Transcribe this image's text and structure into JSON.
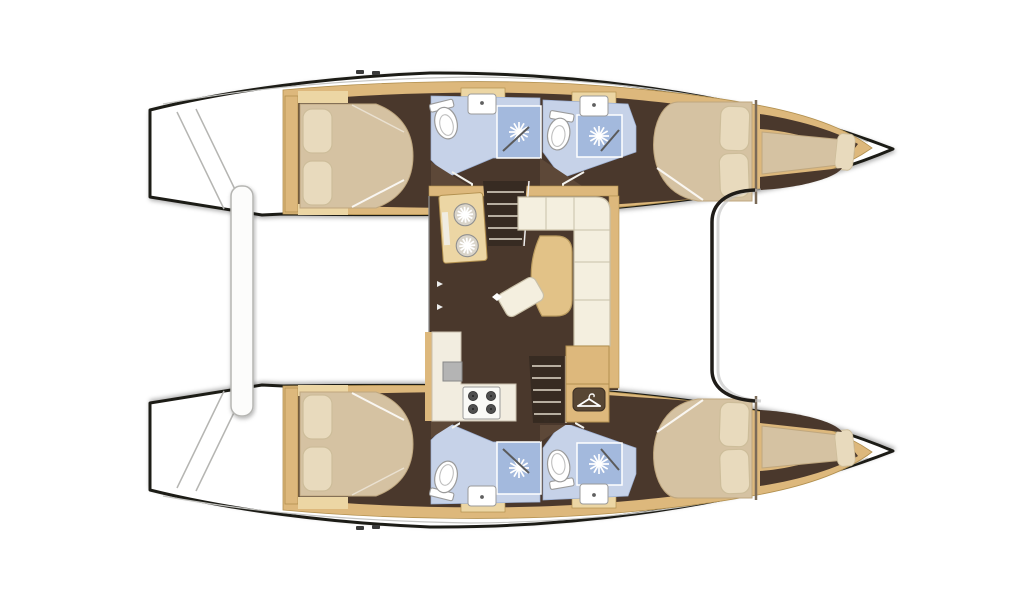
{
  "page": {
    "background": "#ffffff",
    "subject": "catamaran-interior-floor-plan",
    "view": "top-down"
  },
  "layout_info": {
    "vessel": "catamaran",
    "bow_side": "right",
    "stern_side": "left",
    "cabins": 4,
    "heads_with_shower": 4,
    "forepeak_berths": 2
  },
  "palette": {
    "outline": "#1f1c18",
    "deck": "#ffffff",
    "deck_line": "#c4c4c1",
    "wood_trim": "#ddb87c",
    "wood_light": "#ecd6a4",
    "wood_edge": "#b2904f",
    "floor_dark": "#4a382c",
    "floor_wedge": "#5d4838",
    "bed": "#d5c2a2",
    "bed_edge": "#bfa77f",
    "pillow": "#e8dabd",
    "pillow_edge": "#cdbd9a",
    "sofa": "#f4efdf",
    "sofa_edge": "#c9c0a8",
    "table": "#e2c287",
    "table_edge": "#bb9c60",
    "bath_floor": "#c6d2e8",
    "bath_floor_edge": "#9db0d2",
    "shower": "#a3b9dd",
    "fixture": "#ffffff",
    "fixture_edge": "#9a9a9a",
    "stairs": "#372b22",
    "stair_step": "#d8cfc0",
    "counter": "#f2ede0",
    "counter_edge": "#c9c0ae",
    "appliance_gray": "#b4b4b4",
    "burner": "#4f4f4f",
    "wardrobe": "#574634",
    "platform": "#fcfcfb",
    "platform_edge": "#b5b5b2",
    "sinkwheel_base": "#d9d4c9"
  },
  "rooms": {
    "salon_items": [
      "galley-double-sink",
      "companionway-stairs-port",
      "l-shaped-sofa",
      "dining-table",
      "stool",
      "galley-counter",
      "oven",
      "stove-4-burner",
      "companionway-stairs-starboard",
      "wardrobe-cabinet"
    ],
    "hull_items": [
      "aft-cabin-double-bed",
      "aft-head-toilet-sink-shower",
      "forward-head-toilet-sink-shower",
      "forward-cabin-double-bed",
      "forepeak-berth"
    ],
    "exterior_items": [
      "stern-swim-steps",
      "cockpit-bench-platform",
      "foredeck",
      "bow-trampoline-area"
    ]
  }
}
